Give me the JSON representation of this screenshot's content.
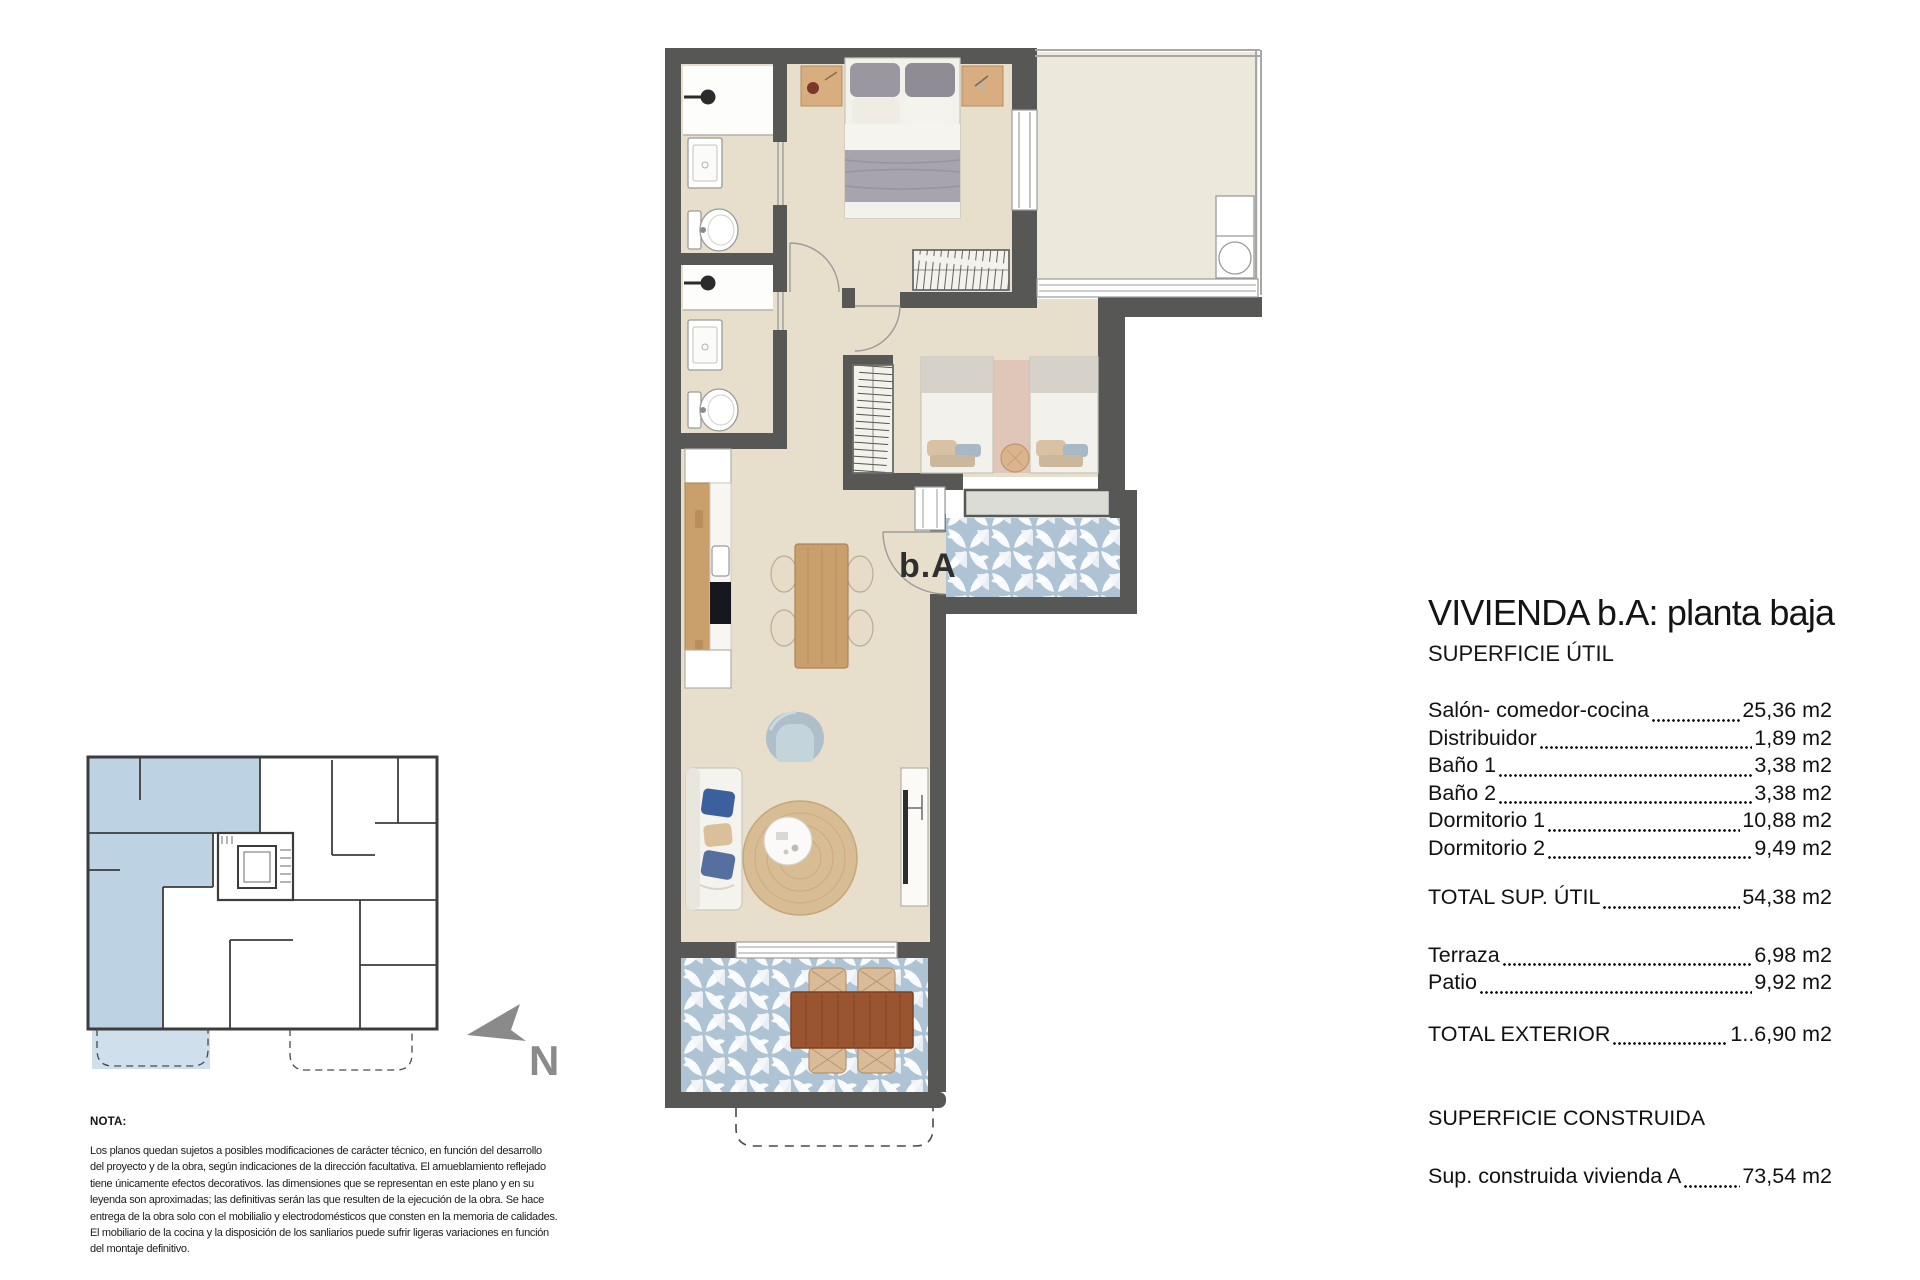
{
  "panel": {
    "title": "VIVIENDA b.A: planta baja",
    "subtitle": "SUPERFICIE ÚTIL",
    "useful_rows": [
      {
        "label": "Salón- comedor-cocina",
        "value": "25,36 m2"
      },
      {
        "label": "Distribuidor",
        "value": "1,89 m2"
      },
      {
        "label": "Baño 1",
        "value": "3,38 m2"
      },
      {
        "label": "Baño 2",
        "value": "3,38 m2"
      },
      {
        "label": "Dormitorio 1",
        "value": "10,88 m2"
      },
      {
        "label": "Dormitorio 2",
        "value": "9,49 m2"
      }
    ],
    "total_util": {
      "label": "TOTAL SUP. ÚTIL",
      "value": "54,38 m2"
    },
    "exterior_rows": [
      {
        "label": "Terraza",
        "value": "6,98 m2"
      },
      {
        "label": "Patio",
        "value": "9,92 m2"
      }
    ],
    "total_exterior": {
      "label": "TOTAL EXTERIOR",
      "value": "1..6,90 m2"
    },
    "construida_heading": "SUPERFICIE CONSTRUIDA",
    "construida_row": {
      "label": "Sup. construida vivienda A",
      "value": "73,54 m2"
    }
  },
  "note": {
    "heading": "NOTA:",
    "body": "Los planos quedan sujetos a posibles modificaciones de carácter técnico, en función del desarrollo\ndel proyecto y de la obra, según indicaciones de la dirección facultativa. El amueblamiento reflejado\ntiene únicamente efectos decorativos. las dimensiones que se representan en este plano y en su\nleyenda son aproximadas; las definitivas serán las que resulten de la ejecución de la obra. Se hace\nentrega de la obra solo con el mobilialio y electrodomésticos que consten en la memoria de calidades.\nEl mobiliario de la cocina y la disposición de los sanliarios puede sufrir ligeras variaciones en función\ndel montaje definitivo."
  },
  "plan": {
    "unit_label": "b.A",
    "north_label": "N"
  },
  "colors": {
    "wall": "#575756",
    "floor_beige": "#e7dfcb",
    "patio_floor": "#ece8dc",
    "tile_blue": "#aec3d4",
    "keyplan_highlight": "#bdd3e3",
    "wood_light": "#c9a06b",
    "terrace_wood": "#9a5530",
    "north_gray": "#8a8a8a",
    "sill_gray": "#dcdcd6"
  }
}
